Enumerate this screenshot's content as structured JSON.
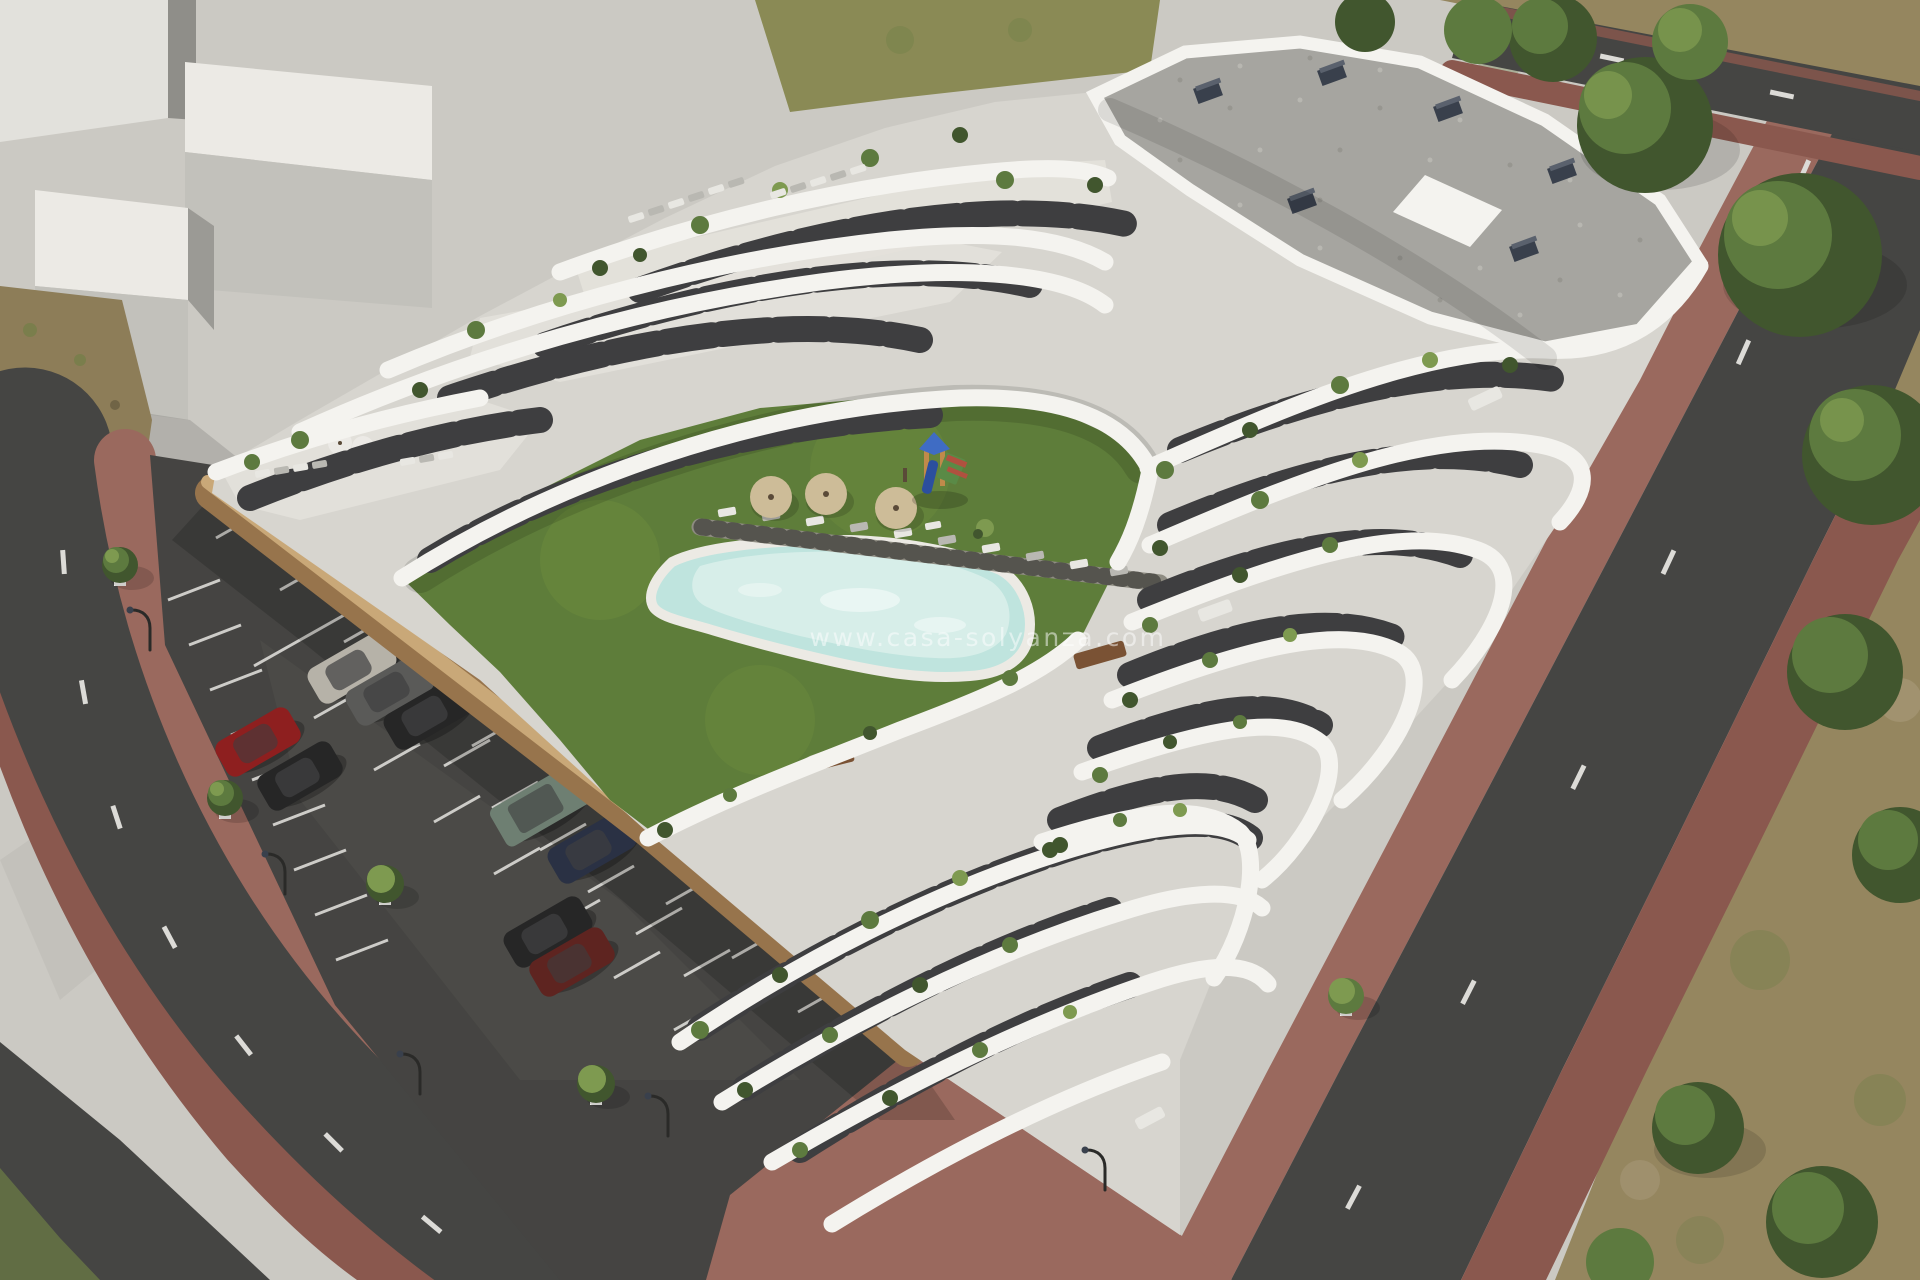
{
  "watermark": {
    "text": "www.casa-solyanza.com"
  },
  "scene": {
    "kind": "aerial 3D architectural render",
    "subject": "modern white terraced apartment complex with curved balcony bands, gravel flat roof, communal lawn with free-form pool, playground, sun loungers, open-air parking lot and perimeter streets",
    "building": {
      "visible_floor_bands": 7,
      "roof": "gray gravel with dark chimney vents and white penthouse volume",
      "facade": "white wavy balcony parapets over dark glazing bands with terrace plants"
    },
    "courtyard": {
      "pool": 1,
      "wood_deck_boards": true,
      "beige_parasols": 3,
      "white_parasols": 2,
      "sun_loungers": 22,
      "playground_towers": 1,
      "dining_tables": 4
    },
    "parking": {
      "striped_rows": 3,
      "street_lamps": 5,
      "garage_door": 1,
      "cars": [
        {
          "color_name": "silver"
        },
        {
          "color_name": "graphite"
        },
        {
          "color_name": "black"
        },
        {
          "color_name": "red"
        },
        {
          "color_name": "black"
        },
        {
          "color_name": "green-suv"
        },
        {
          "color_name": "navy"
        },
        {
          "color_name": "black"
        },
        {
          "color_name": "dark-red"
        }
      ]
    },
    "streets": {
      "lane_markings": "white dashes",
      "sidewalks": "red-brown pavers",
      "roads": 4
    },
    "background": {
      "massing_blocks": 4,
      "dry_terrain": true,
      "trees": 18
    }
  },
  "palette": {
    "ground": "#cbc9c3",
    "block_top": "#eceae5",
    "block_front": "#c2c1bb",
    "block_side": "#9b9a95",
    "block_dark": "#8f8e89",
    "block_wall": "#e2e1dc",
    "dirt": "#8d7d58",
    "dirt_green": "#6e7f45",
    "drygrass": "#8a8a55",
    "terrain": "#95865f",
    "terrain_green": "#6d7f48",
    "terrain_light": "#b0a183",
    "road": "#454543",
    "lane_dash": "#e8e8e6",
    "sidewalk": "#9a695e",
    "sidewalk_dark": "#8a584e",
    "asphalt": "#454442",
    "asphalt_light": "#56554f",
    "stripe": "#dcdbd7",
    "wall_lit": "#c9a878",
    "wall_shadow": "#97744c",
    "garage": "#2b2b28",
    "lawn": "#5e7d3a",
    "lawn_light": "#74923f",
    "pool_water": "#bfe4de",
    "pool_light": "#dff2ec",
    "pool_coping": "#eceae4",
    "deck": "#8e8c82",
    "deck_gap": "#55544e",
    "building_base": "#d7d5cf",
    "building_white": "#f4f3ef",
    "terrace_floor": "#e3e1da",
    "glazing": "#3e3e40",
    "facade_gray": "#6e6e6a",
    "roof_gravel": "#a6a5a0",
    "roof_speck_dark": "#8e8d87",
    "roof_speck_light": "#c4c3bd",
    "chimney": "#39404c",
    "chimney_top": "#5a616d",
    "plant_dark": "#41562e",
    "plant_mid": "#5d7a3f",
    "plant_light": "#7e9a50",
    "trunk": "#5a4a38",
    "parasol": "#cdbc98",
    "parasol_white": "#eceae6",
    "lounger": "#e8e7e2",
    "lounger_dark": "#b9b8b2",
    "table_brown": "#7a5234",
    "play_blue": "#3f6cc4",
    "play_blue_dark": "#2b4f9e",
    "play_orange": "#c08a4a",
    "play_green": "#5a8a46",
    "play_red": "#b0513f",
    "car_silver": "#b6b2a8",
    "car_graphite": "#5a5a58",
    "car_black": "#262626",
    "car_red": "#8e1f1f",
    "car_navy": "#2a3144",
    "car_green": "#6e7f72",
    "car_darkred": "#5e2420",
    "lamp": "#2a2a28"
  }
}
